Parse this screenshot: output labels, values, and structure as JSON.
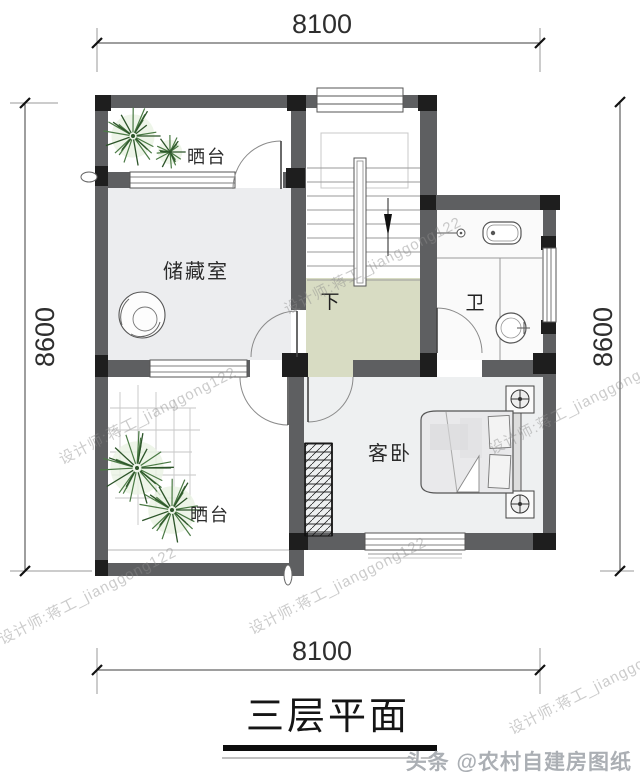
{
  "title": {
    "text": "三层平面"
  },
  "dimensions": {
    "top": "8100",
    "bottom": "8100",
    "left": "8600",
    "right": "8600"
  },
  "rooms": {
    "terrace_top": "晒台",
    "storage": "储藏室",
    "stair_direction": "下",
    "bathroom": "卫",
    "guest_bedroom": "客卧",
    "terrace_bottom": "晒台"
  },
  "watermarks": {
    "designer": "设计师:蒋工_jianggong122",
    "brand": "头条 @农村自建房图纸"
  },
  "colors": {
    "wall": "#5e5f61",
    "wall_dark": "#1e1e1e",
    "hall_floor": "#d8dcc3",
    "room_floor": "#ecedef",
    "bedroom_floor": "#eef0f1",
    "bath_floor": "#fafafa",
    "plant_green": "#4a7a44",
    "plant_green_dark": "#2c5429",
    "dim_line": "#3c3c3c",
    "brand_gray": "#abafb4"
  }
}
